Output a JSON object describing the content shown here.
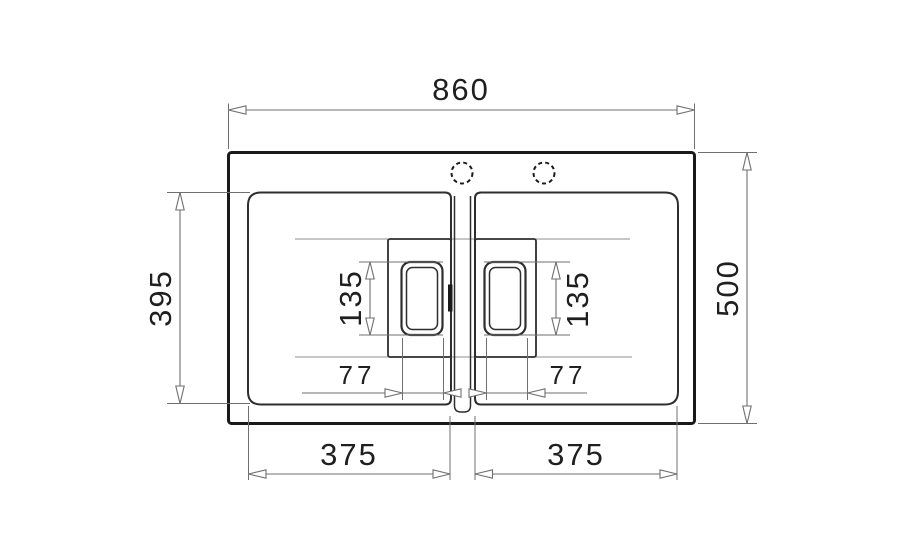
{
  "drawing": {
    "kind": "double-bowl sink plan view with dimensions"
  },
  "dimensions": {
    "overall_width": "860",
    "overall_depth": "500",
    "bowl_depth": "395",
    "drain_left_height": "135",
    "drain_right_height": "135",
    "drain_left_width": "77",
    "drain_right_width": "77",
    "bowl_left_width": "375",
    "bowl_right_width": "375"
  },
  "colors": {
    "outline": "#1a1a1a",
    "part_line": "#2e2e2e",
    "dimension_line": "#6f6f6f",
    "reference_line": "#8f8f8f",
    "text": "#1f1f1f",
    "background": "#ffffff"
  }
}
